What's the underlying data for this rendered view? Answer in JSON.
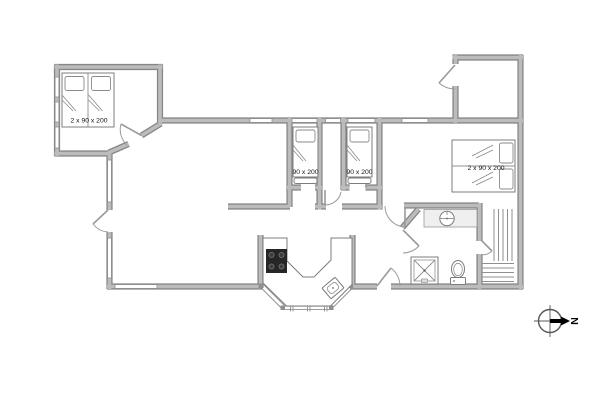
{
  "title": "holiday-home-floor-plan",
  "rooms": {
    "bedroom_top_left": {
      "bed_size_label": "2 x 90 x 200"
    },
    "bedroom_middle_left": {
      "bed_size_label": "90 x 200"
    },
    "bedroom_middle_right": {
      "bed_size_label": "90 x 200"
    },
    "bedroom_right": {
      "bed_size_label": "2 x 90 x 200"
    }
  },
  "compass": {
    "north_label": "N"
  },
  "icons": {
    "stove": "4-burner-cooktop",
    "kitchen_sink": "rotated-sink-basin",
    "washbasin": "round-basin-on-counter",
    "shower": "square-with-cross",
    "toilet": "bowl-with-cistern",
    "sauna": "bench-slats",
    "compass": "circle-crosshair-arrow"
  },
  "colors": {
    "wall_edge": "#878787",
    "wall_fill": "#bcbcbc",
    "thin_line": "#8f8f8f",
    "fixture_dark": "#262626",
    "floor": "#ffffff",
    "label_text": "#111111"
  }
}
